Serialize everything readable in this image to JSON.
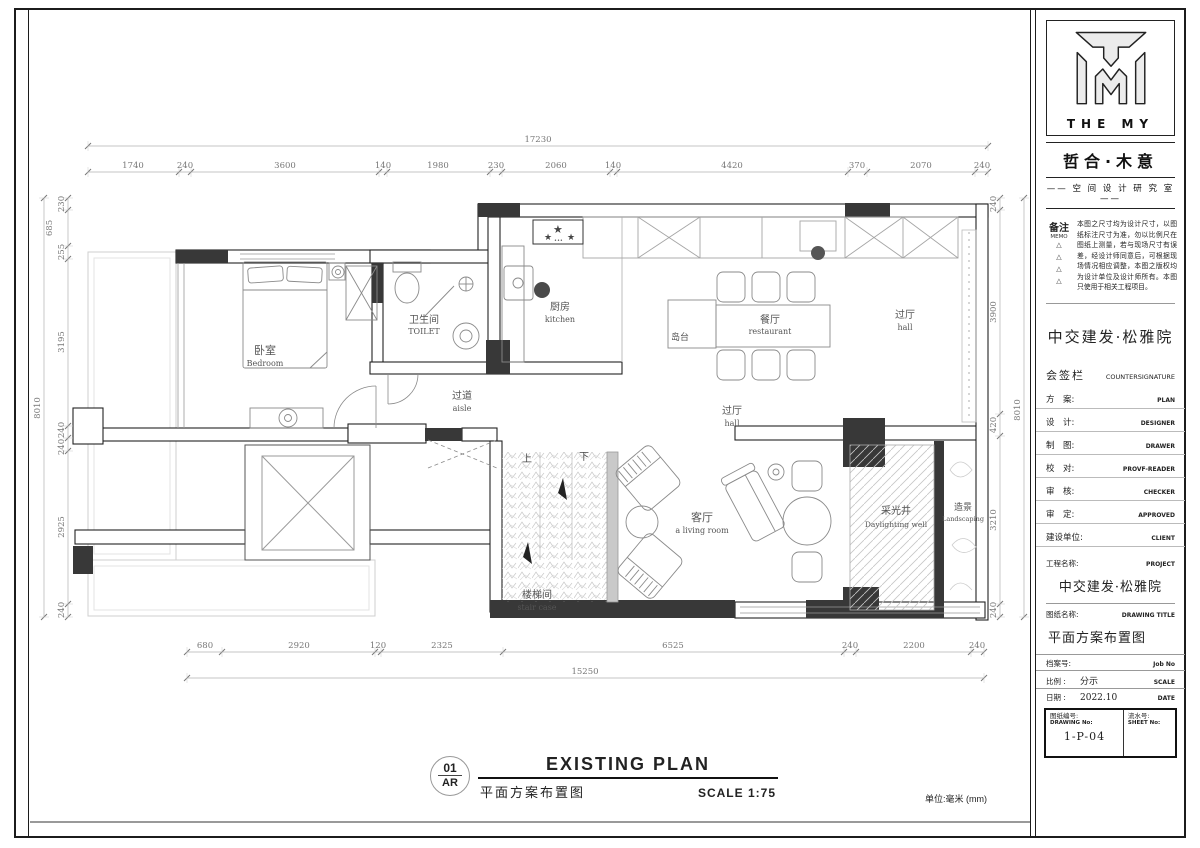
{
  "title_block": {
    "logo": {
      "brand": "THE MY",
      "name_zh": "哲合·木意",
      "studio_display": "—— 空 间 设 计 研 究 室 ——"
    },
    "memo": {
      "label_zh": "备注",
      "label_en": "MEMO",
      "text": "本图之尺寸均为设计尺寸，以图纸标注尺寸为准，勿以比例尺在图纸上测量，若与现场尺寸有误差，经设计师同意后，可根据现场情况相应调整，本图之版权均为设计单位及设计师所有。本图只使用于相关工程项目。"
    },
    "client_banner": "中交建发·松雅院",
    "countersignature": {
      "zh": "会签栏",
      "en": "COUNTERSIGNATURE"
    },
    "sign_rows": [
      {
        "zh": "方　案:",
        "en": "PLAN"
      },
      {
        "zh": "设　计:",
        "en": "DESIGNER"
      },
      {
        "zh": "制　图:",
        "en": "DRAWER"
      },
      {
        "zh": "校　对:",
        "en": "PROVF-READER"
      },
      {
        "zh": "审　核:",
        "en": "CHECKER"
      },
      {
        "zh": "审　定:",
        "en": "APPROVED"
      },
      {
        "zh": "建设单位:",
        "en": "CLIENT"
      }
    ],
    "project": {
      "label_zh": "工程名称:",
      "label_en": "PROJECT",
      "value": "中交建发·松雅院"
    },
    "drawing": {
      "label_zh": "图纸名称:",
      "label_en": "DRAWING TITLE",
      "value": "平面方案布置图"
    },
    "meta_rows": [
      {
        "zh": "档案号:",
        "value": "",
        "en": "Job No"
      },
      {
        "zh": "比例 :",
        "value": "分示",
        "en": "SCALE"
      },
      {
        "zh": "日期 :",
        "value": "2022.10",
        "en": "DATE"
      }
    ],
    "number": {
      "label_zh": "图纸编号:",
      "label_en": "DRAWING No:",
      "value": "1-P-04",
      "sheet_zh": "流水号:",
      "sheet_en": "SHEET No:"
    }
  },
  "plan": {
    "rooms": {
      "bedroom": {
        "zh": "卧室",
        "en": "Bedroom"
      },
      "toilet": {
        "zh": "卫生间",
        "en": "TOILET"
      },
      "kitchen": {
        "zh": "厨房",
        "en": "kitchen"
      },
      "dining": {
        "zh": "餐厅",
        "en": "restaurant"
      },
      "island": {
        "zh": "岛台"
      },
      "hall_upper": {
        "zh": "过厅",
        "en": "hall"
      },
      "hall_lower": {
        "zh": "过厅",
        "en": "hall"
      },
      "aisle": {
        "zh": "过道",
        "en": "aisle"
      },
      "living": {
        "zh": "客厅",
        "en": "a living room"
      },
      "daylight": {
        "zh": "采光井",
        "en": "Daylighting well"
      },
      "landscape": {
        "zh": "造景",
        "en": "Landscaping"
      },
      "stair": {
        "zh": "楼梯间",
        "en": "stair case"
      },
      "up": "上",
      "down": "下"
    },
    "dims": {
      "top": {
        "overall": "17230",
        "segments": [
          "1740",
          "240",
          "3600",
          "140",
          "1980",
          "230",
          "2060",
          "140",
          "4420",
          "370",
          "2070",
          "240"
        ]
      },
      "left": {
        "overall": "8010",
        "segments": [
          "230",
          "685",
          "255",
          "3195",
          "240",
          "240",
          "2925",
          "240"
        ]
      },
      "right": {
        "overall": "8010",
        "segments": [
          "240",
          "3900",
          "420",
          "3210",
          "240"
        ]
      },
      "bottom": {
        "overall": "15250",
        "segments": [
          "680",
          "2920",
          "120",
          "2325",
          "6525",
          "240",
          "2200",
          "240"
        ]
      }
    },
    "unit_note": "单位:毫米 (mm)"
  },
  "caption": {
    "number": "01",
    "code": "AR",
    "title_en": "EXISTING PLAN",
    "title_zh": "平面方案布置图",
    "scale_label": "SCALE 1:75"
  }
}
